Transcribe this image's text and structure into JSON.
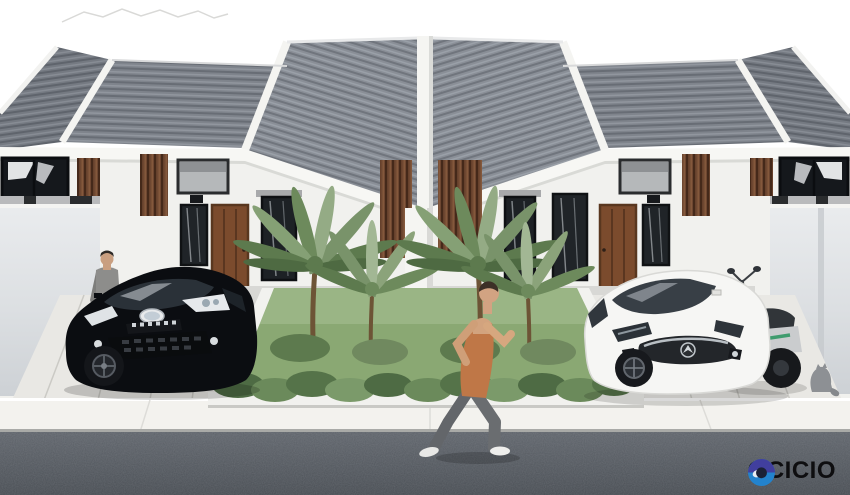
{
  "logo": {
    "text": "OCICIO",
    "icon": "ring-swirl-logo-icon",
    "icon_colors": {
      "top": "#413f9e",
      "bottom": "#2383cd",
      "center": "#1b2136",
      "highlight": "#e8edf2"
    },
    "text_color": "#0e0e10"
  },
  "scene": {
    "type": "architectural-exterior-rendering",
    "subject": "two identical modern minimalist single-story row houses",
    "elements": [
      "gray-corrugated-roofs",
      "white-fascia-bands",
      "dark-clerestory-windows",
      "brown-wood-slat-panels",
      "wood-entry-doors",
      "curtained-windows",
      "center-party-wall-pillar",
      "tropical-garden-with-palms",
      "front-shrub-row",
      "concrete-driveways",
      "white-sidewalk-curb",
      "asphalt-road",
      "black-hatchback-car",
      "white-mazda-sedan",
      "white-scooter",
      "standing-man-gray-suit",
      "jogging-man-orange-tank",
      "small-gray-cat"
    ],
    "palette": {
      "sky": "#ffffff",
      "roof_gray": "#878c94",
      "wall_white": "#f1f1ee",
      "wood_brown": "#6e4731",
      "grass_green": "#8aa873",
      "frond_green": "#79936a",
      "road_asphalt": "#585d63",
      "black_car": "#0b0d11",
      "white_car": "#f6f6f4",
      "tank_top_orange": "#c27848"
    }
  }
}
